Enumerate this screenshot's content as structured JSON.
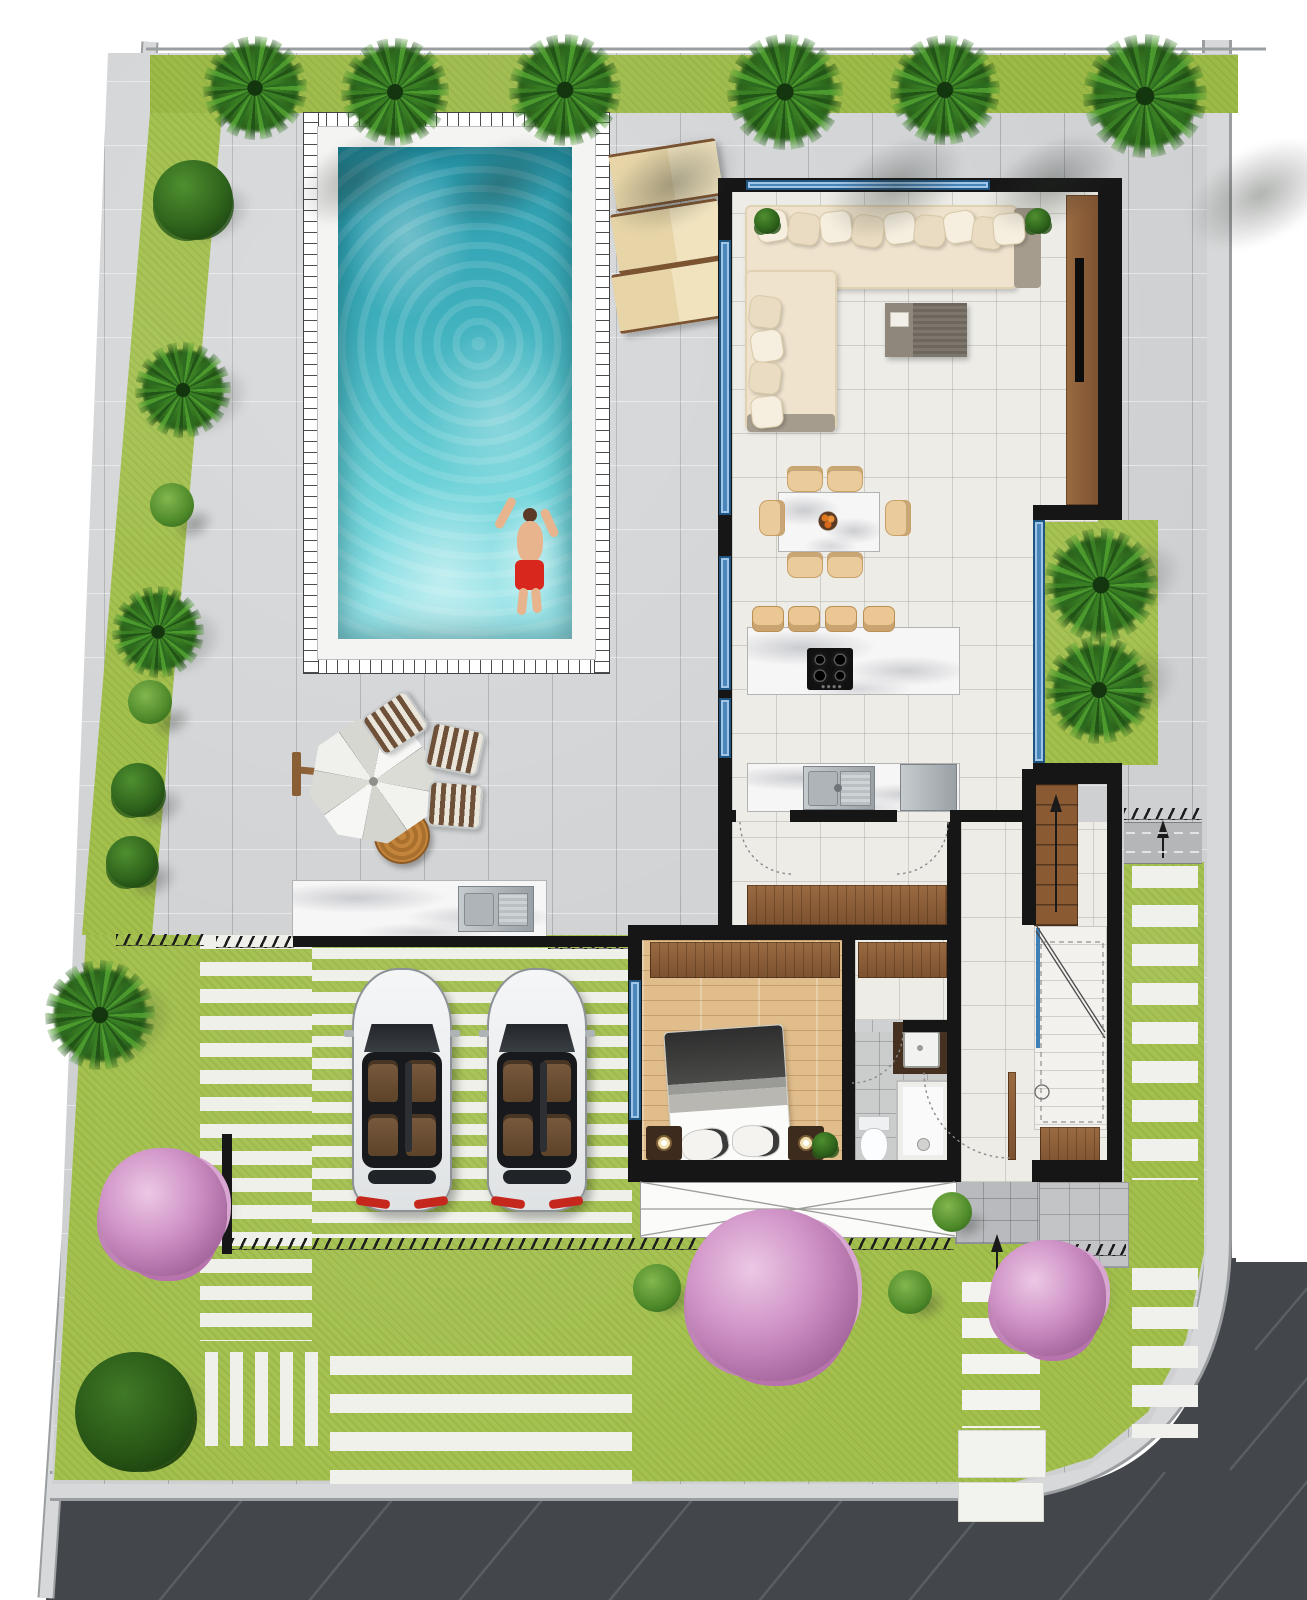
{
  "canvas": {
    "width": 1307,
    "height": 1600
  },
  "palette": {
    "page_bg": "#ffffff",
    "road": "#43474b",
    "road_marking": "#5a5f63",
    "sidewalk": "#d7d8d9",
    "sidewalk_edge": "#9b9ea0",
    "paving": "#ced0d2",
    "grass": "#a3c04d",
    "grass_top": "#9cba47",
    "wall": "#161616",
    "glass": "#4a86ba",
    "interior_tile": "#edece7",
    "wood": "#8a5f3c",
    "bedroom_floor": "#e0bd8b",
    "marble": "#f6f6f6",
    "pool_deep": "#2596aa",
    "pool_light": "#a5eaed",
    "sofa": "#efe3cd",
    "lounger": "#ead9ae",
    "umbrella": "#efefec",
    "car_body": "#f3f4f5",
    "car_interior": "#6d4f35",
    "taillight": "#c6271d",
    "blossom": "#cf92c6",
    "palm_green": "#3b7f24",
    "swim_shorts": "#d8271d"
  },
  "scene": {
    "description": "Top-down architectural site plan of a villa: swimming pool with swimmer, sun loungers, cantilever umbrella with deck chairs, open-plan living/dining/kitchen, bedroom with bathroom, staircase, double carport with two white cars, lawns, palm trees, pink blossom shrubs, perimeter sidewalks and asphalt road",
    "walls": [
      [
        718,
        178,
        404,
        14
      ],
      [
        718,
        192,
        14,
        748
      ],
      [
        1098,
        192,
        24,
        328
      ],
      [
        1033,
        505,
        89,
        15
      ],
      [
        1033,
        763,
        89,
        15
      ],
      [
        1034,
        769,
        88,
        15
      ],
      [
        1022,
        769,
        14,
        156
      ],
      [
        1107,
        769,
        15,
        413
      ],
      [
        718,
        810,
        18,
        12
      ],
      [
        790,
        810,
        107,
        12
      ],
      [
        950,
        810,
        72,
        12
      ],
      [
        947,
        822,
        14,
        360
      ],
      [
        628,
        925,
        332,
        15
      ],
      [
        628,
        940,
        14,
        242
      ],
      [
        842,
        940,
        13,
        242
      ],
      [
        845,
        1020,
        7,
        12
      ],
      [
        903,
        1020,
        58,
        12
      ],
      [
        628,
        1160,
        327,
        22
      ],
      [
        1032,
        1160,
        90,
        22
      ],
      [
        293,
        936,
        339,
        11
      ],
      [
        222,
        1134,
        10,
        120
      ]
    ],
    "windows": [
      [
        746,
        180,
        244,
        10
      ],
      [
        719,
        240,
        12,
        275
      ],
      [
        719,
        556,
        12,
        134
      ],
      [
        719,
        698,
        12,
        60
      ],
      [
        1033,
        520,
        12,
        243
      ],
      [
        629,
        980,
        12,
        140
      ]
    ],
    "floors": [
      {
        "x": 732,
        "y": 192,
        "w": 366,
        "h": 330,
        "cls": "floor-tile",
        "name": "living-room-floor"
      },
      {
        "x": 732,
        "y": 520,
        "w": 301,
        "h": 302,
        "cls": "floor-tile",
        "name": "kitchen-floor"
      },
      {
        "x": 732,
        "y": 822,
        "w": 215,
        "h": 104,
        "cls": "floor-tile",
        "name": "hallway-floor"
      },
      {
        "x": 961,
        "y": 822,
        "w": 146,
        "h": 360,
        "cls": "floor-tile",
        "name": "entry-hall-floor"
      },
      {
        "x": 855,
        "y": 940,
        "w": 92,
        "h": 80,
        "cls": "floor-tile",
        "name": "utility-floor"
      },
      {
        "x": 642,
        "y": 940,
        "w": 200,
        "h": 222,
        "cls": "floor-wood",
        "name": "bedroom-floor"
      },
      {
        "x": 855,
        "y": 1032,
        "w": 92,
        "h": 130,
        "cls": "floor-bath",
        "name": "bathroom-floor"
      }
    ],
    "wardrobes": [
      [
        747,
        885,
        200,
        40
      ],
      [
        650,
        942,
        190,
        36
      ],
      [
        858,
        942,
        89,
        36
      ],
      [
        1040,
        1127,
        60,
        40
      ]
    ],
    "stripe_groups": [
      {
        "x": 200,
        "y": 935,
        "w": 112,
        "h": 406,
        "d": "h",
        "b": 14,
        "g": 13,
        "c": "#eff0ea",
        "name": "walk-slabs-left"
      },
      {
        "x": 312,
        "y": 948,
        "w": 320,
        "h": 290,
        "d": "h",
        "b": 11,
        "g": 11,
        "c": "#eef0e9",
        "name": "carport-stripes"
      },
      {
        "x": 205,
        "y": 1352,
        "w": 113,
        "h": 94,
        "d": "v",
        "b": 13,
        "g": 12,
        "c": "#eff0ea",
        "name": "walk-slabs-small"
      },
      {
        "x": 330,
        "y": 1356,
        "w": 302,
        "h": 128,
        "d": "h",
        "b": 19,
        "g": 19,
        "c": "#f0f1eb",
        "name": "driveway-stripes"
      },
      {
        "x": 1132,
        "y": 866,
        "w": 66,
        "h": 314,
        "d": "h",
        "b": 22,
        "g": 17,
        "c": "#f0f1ec",
        "name": "side-slabs-upper"
      },
      {
        "x": 1132,
        "y": 1268,
        "w": 66,
        "h": 170,
        "d": "h",
        "b": 22,
        "g": 17,
        "c": "#f0f1ec",
        "name": "side-slabs-lower"
      },
      {
        "x": 962,
        "y": 1282,
        "w": 78,
        "h": 146,
        "d": "h",
        "b": 20,
        "g": 16,
        "c": "#f3f3ef",
        "name": "entrance-walk"
      }
    ],
    "big_slabs": [
      [
        958,
        1430,
        86,
        46
      ],
      [
        958,
        1482,
        84,
        38
      ]
    ],
    "hatch_strips": [
      [
        116,
        934,
        88
      ],
      [
        216,
        936,
        78
      ],
      [
        548,
        937,
        82
      ],
      [
        232,
        1238,
        722
      ],
      [
        1040,
        1244,
        86
      ],
      [
        1124,
        808,
        78
      ]
    ],
    "top_palms": [
      [
        255,
        88,
        52
      ],
      [
        395,
        92,
        54
      ],
      [
        565,
        90,
        56
      ],
      [
        785,
        92,
        58
      ],
      [
        945,
        90,
        55
      ],
      [
        1145,
        96,
        62
      ]
    ],
    "left_plants": [
      {
        "t": "bush-dark",
        "x": 193,
        "y": 200,
        "r": 40
      },
      {
        "t": "palm",
        "x": 183,
        "y": 390,
        "r": 48
      },
      {
        "t": "bush-round",
        "x": 172,
        "y": 505,
        "r": 22
      },
      {
        "t": "palm",
        "x": 158,
        "y": 632,
        "r": 46
      },
      {
        "t": "bush-round",
        "x": 150,
        "y": 702,
        "r": 22
      },
      {
        "t": "bush-dark",
        "x": 138,
        "y": 790,
        "r": 27
      },
      {
        "t": "bush-dark",
        "x": 132,
        "y": 862,
        "r": 26
      },
      {
        "t": "palm",
        "x": 100,
        "y": 1015,
        "r": 55
      }
    ],
    "garden_plants": [
      {
        "t": "pink",
        "x": 163,
        "y": 1212,
        "r": 64
      },
      {
        "t": "green",
        "x": 135,
        "y": 1412,
        "r": 60
      },
      {
        "t": "pink",
        "x": 772,
        "y": 1295,
        "r": 86
      },
      {
        "t": "round",
        "x": 657,
        "y": 1288,
        "r": 24
      },
      {
        "t": "round",
        "x": 910,
        "y": 1292,
        "r": 22
      },
      {
        "t": "round",
        "x": 952,
        "y": 1212,
        "r": 20
      },
      {
        "t": "pink",
        "x": 1048,
        "y": 1298,
        "r": 58
      }
    ],
    "recess_trees": [
      [
        1101,
        585,
        57
      ],
      [
        1099,
        690,
        54
      ]
    ],
    "corner_plants": [
      [
        754,
        208,
        26
      ],
      [
        1025,
        208,
        26
      ],
      [
        812,
        1132,
        26
      ]
    ],
    "loungers": [
      [
        612,
        146,
        108,
        52,
        -9
      ],
      [
        614,
        206,
        108,
        54,
        -9
      ],
      [
        615,
        266,
        110,
        54,
        -9
      ]
    ],
    "deck_chairs": [
      [
        368,
        700,
        -34
      ],
      [
        428,
        726,
        12
      ],
      [
        428,
        782,
        4
      ]
    ],
    "bar_stools": [
      752,
      788,
      825,
      863
    ],
    "dining_chairs": [
      [
        787,
        466,
        0
      ],
      [
        827,
        466,
        0
      ],
      [
        787,
        552,
        0
      ],
      [
        827,
        552,
        0
      ],
      [
        754,
        505,
        90
      ],
      [
        880,
        505,
        90
      ]
    ],
    "sofa_pillows": [
      [
        756,
        210,
        -10
      ],
      [
        788,
        213,
        8
      ],
      [
        820,
        211,
        -7
      ],
      [
        852,
        215,
        9
      ],
      [
        884,
        212,
        -8
      ],
      [
        914,
        215,
        6
      ],
      [
        944,
        211,
        -10
      ],
      [
        972,
        217,
        8
      ],
      [
        993,
        213,
        -5
      ],
      [
        749,
        296,
        8
      ],
      [
        751,
        330,
        -9
      ],
      [
        749,
        362,
        7
      ],
      [
        751,
        396,
        -6
      ]
    ],
    "cars": [
      [
        352,
        968
      ],
      [
        487,
        968
      ]
    ],
    "counts": {
      "palm_trees_top": 6,
      "cars": 2,
      "sun_loungers": 3,
      "deck_chairs": 3,
      "dining_chairs": 6,
      "bar_stools": 4
    }
  }
}
